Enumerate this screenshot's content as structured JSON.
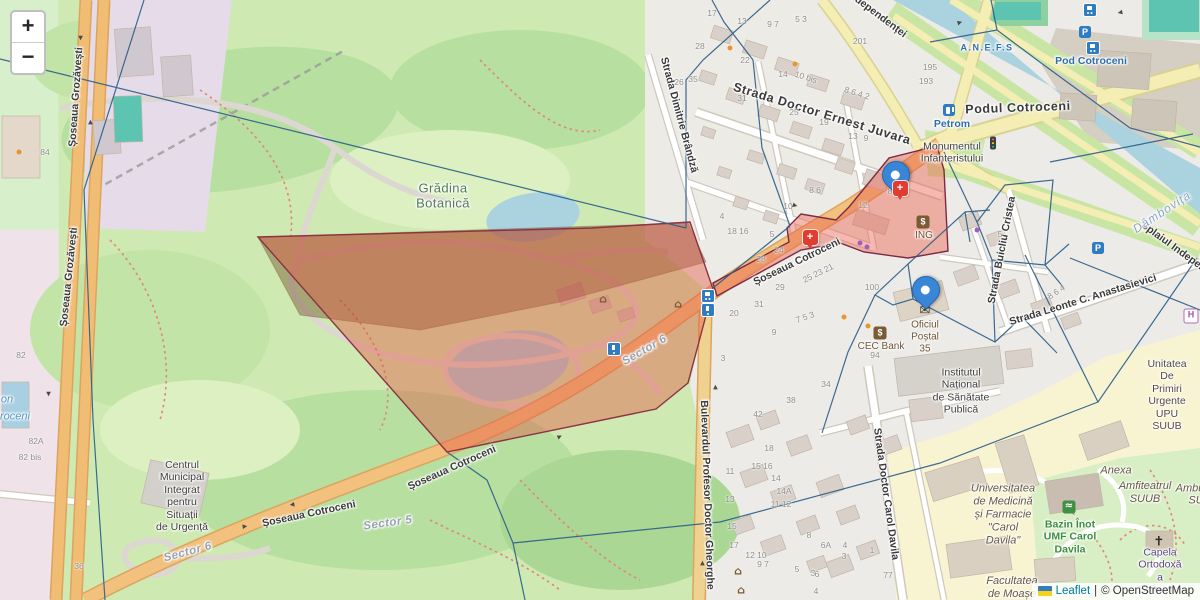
{
  "controls": {
    "zoom_in": "+",
    "zoom_out": "−"
  },
  "attribution": {
    "leaflet": "Leaflet",
    "sep": "|",
    "osm": "© OpenStreetMap",
    "flag_icon": "ukraine-flag",
    "flag_colors": [
      "#357ebd",
      "#f7d117"
    ]
  },
  "overlay_colors": {
    "selection_fill": "rgba(229,83,64,0.42)",
    "selection_dark_fill": "rgba(105,62,25,0.40)",
    "selection_stroke": "#7d3146",
    "voronoi_stroke": "#2d5f8a",
    "marker_blue": "#3a86d6",
    "marker_red": "#e23b30"
  },
  "glyphs": {
    "arrow": "▶",
    "parking": "P",
    "bank": "$",
    "hospital": "H",
    "swim": "≈",
    "museum": "⌂",
    "post": "✉",
    "chapel": "✝",
    "medical_cross": "+"
  },
  "streets": [
    {
      "text": "Șoseaua Grozăvești",
      "x": 76,
      "y": 97,
      "r": -86
    },
    {
      "text": "Șoseaua Grozăvești",
      "x": 69,
      "y": 277,
      "r": -84
    },
    {
      "text": "Strada Doctor Ernest Juvara",
      "x": 822,
      "y": 114,
      "r": 17,
      "cls": "major"
    },
    {
      "text": "Șoseaua Cotroceni",
      "x": 797,
      "y": 262,
      "r": -26
    },
    {
      "text": "Șoseaua Cotroceni",
      "x": 452,
      "y": 468,
      "r": -24
    },
    {
      "text": "Șoseaua Cotroceni",
      "x": 309,
      "y": 514,
      "r": -12
    },
    {
      "text": "Bulevardul Profesor Doctor Gheorghe",
      "x": 707,
      "y": 495,
      "r": 88
    },
    {
      "text": "Strada Doctor Carol Davila",
      "x": 886,
      "y": 494,
      "r": 82
    },
    {
      "text": "Strada Dimitrie Brândză",
      "x": 679,
      "y": 115,
      "r": 75
    },
    {
      "text": "Strada Buicliu Cristea",
      "x": 1002,
      "y": 250,
      "r": -79
    },
    {
      "text": "Strada Leonte C. Anastasievici",
      "x": 1083,
      "y": 300,
      "r": -17
    },
    {
      "text": "Splaiul Independenței",
      "x": 862,
      "y": 3,
      "r": 37
    },
    {
      "text": "Splaiul Independenței",
      "x": 1186,
      "y": 256,
      "r": 36
    },
    {
      "text": "Podul Cotroceni",
      "x": 1018,
      "y": 108,
      "r": -2,
      "cls": "major"
    }
  ],
  "places": [
    {
      "text": "Grădina\nBotanică",
      "x": 443,
      "y": 196,
      "cls": "p-green"
    },
    {
      "text": "Pod Cotroceni",
      "x": 1091,
      "y": 61,
      "cls": "p-blue"
    },
    {
      "text": "A.N.E.F.S",
      "x": 987,
      "y": 48,
      "cls": "p-bluesm"
    },
    {
      "text": "Petrom",
      "x": 952,
      "y": 124,
      "cls": "p-blue"
    },
    {
      "text": "Monumentul\nInfanteristului",
      "x": 952,
      "y": 153,
      "cls": "p-dark"
    },
    {
      "text": "Dâmbovița",
      "x": 1162,
      "y": 212,
      "cls": "p-water",
      "r": -33
    },
    {
      "text": "Sector 6",
      "x": 645,
      "y": 351,
      "cls": "p-sector",
      "r": -30
    },
    {
      "text": "Sector 6",
      "x": 188,
      "y": 553,
      "cls": "p-sector",
      "r": -15
    },
    {
      "text": "Sector 5",
      "x": 388,
      "y": 524,
      "cls": "p-sector",
      "r": -8
    },
    {
      "text": "ING",
      "x": 924,
      "y": 236,
      "cls": "p-amen"
    },
    {
      "text": "CEC Bank",
      "x": 881,
      "y": 347,
      "cls": "p-amen"
    },
    {
      "text": "Oficiul\nPoștal\n35",
      "x": 925,
      "y": 337,
      "cls": "p-amen"
    },
    {
      "text": "Institutul\nNațional\nde Sănătate\nPublică",
      "x": 961,
      "y": 391,
      "cls": "p-dark"
    },
    {
      "text": "Centrul\nMunicipal\nIntegrat\npentru\nSituații\nde Urgență",
      "x": 182,
      "y": 496,
      "cls": "p-dark"
    },
    {
      "text": "Universitatea\nde Medicină\nși Farmacie\n\"Carol\nDavila\"",
      "x": 1003,
      "y": 515,
      "cls": "p-univ"
    },
    {
      "text": "Anexa",
      "x": 1116,
      "y": 471,
      "cls": "p-univ"
    },
    {
      "text": "Amfiteatrul\nSUUB",
      "x": 1145,
      "y": 493,
      "cls": "p-univ"
    },
    {
      "text": "Ambu",
      "x": 1190,
      "y": 489,
      "cls": "p-univ"
    },
    {
      "text": "SU",
      "x": 1196,
      "y": 501,
      "cls": "p-univ"
    },
    {
      "text": "Bazin Înot\nUMF Carol\nDavila",
      "x": 1070,
      "y": 537,
      "cls": "p-greensm"
    },
    {
      "text": "Capela\nOrtodoxă\na Spitalului",
      "x": 1160,
      "y": 571,
      "cls": "p-purple"
    },
    {
      "text": "Unitatea\nDe Primiri\nUrgente\nUPU\nSUUB",
      "x": 1167,
      "y": 395,
      "cls": "p-hosp"
    },
    {
      "text": "Facultatea\nde Moașe",
      "x": 1012,
      "y": 588,
      "cls": "p-univ"
    },
    {
      "text": "on",
      "x": 7,
      "y": 400,
      "cls": "p-waterblue"
    },
    {
      "text": "roceni",
      "x": 15,
      "y": 417,
      "cls": "p-waterblue"
    }
  ],
  "house_numbers": [
    {
      "t": "84",
      "x": 45,
      "y": 152
    },
    {
      "t": "82",
      "x": 21,
      "y": 355
    },
    {
      "t": "82A",
      "x": 36,
      "y": 441
    },
    {
      "t": "82 bis",
      "x": 30,
      "y": 457
    },
    {
      "t": "36",
      "x": 79,
      "y": 566
    },
    {
      "t": "201",
      "x": 860,
      "y": 41
    },
    {
      "t": "195",
      "x": 930,
      "y": 67
    },
    {
      "t": "193",
      "x": 926,
      "y": 81
    },
    {
      "t": "17",
      "x": 712,
      "y": 13
    },
    {
      "t": "13",
      "x": 742,
      "y": 21
    },
    {
      "t": "9 7",
      "x": 773,
      "y": 24
    },
    {
      "t": "5 3",
      "x": 801,
      "y": 19
    },
    {
      "t": "28",
      "x": 700,
      "y": 46
    },
    {
      "t": "22",
      "x": 745,
      "y": 60
    },
    {
      "t": "14",
      "x": 783,
      "y": 74
    },
    {
      "t": "10 bis",
      "x": 806,
      "y": 77,
      "r": 17
    },
    {
      "t": "26",
      "x": 679,
      "y": 82
    },
    {
      "t": "35",
      "x": 693,
      "y": 79
    },
    {
      "t": "8 6 4 2",
      "x": 857,
      "y": 93,
      "r": 17
    },
    {
      "t": "31",
      "x": 742,
      "y": 98
    },
    {
      "t": "25",
      "x": 794,
      "y": 112
    },
    {
      "t": "19",
      "x": 824,
      "y": 122
    },
    {
      "t": "13",
      "x": 853,
      "y": 136
    },
    {
      "t": "9",
      "x": 866,
      "y": 138
    },
    {
      "t": "12",
      "x": 863,
      "y": 205
    },
    {
      "t": "8",
      "x": 890,
      "y": 191
    },
    {
      "t": "10",
      "x": 788,
      "y": 206
    },
    {
      "t": "8 6",
      "x": 815,
      "y": 190
    },
    {
      "t": "4",
      "x": 722,
      "y": 216
    },
    {
      "t": "18 16",
      "x": 738,
      "y": 231
    },
    {
      "t": "5",
      "x": 772,
      "y": 234
    },
    {
      "t": "24",
      "x": 779,
      "y": 250
    },
    {
      "t": "28",
      "x": 761,
      "y": 259
    },
    {
      "t": "25 23 21",
      "x": 818,
      "y": 273,
      "r": -26
    },
    {
      "t": "29",
      "x": 780,
      "y": 287
    },
    {
      "t": "20",
      "x": 734,
      "y": 313
    },
    {
      "t": "31",
      "x": 759,
      "y": 304
    },
    {
      "t": "100",
      "x": 872,
      "y": 287
    },
    {
      "t": "7 5 3",
      "x": 805,
      "y": 317,
      "r": -20
    },
    {
      "t": "9",
      "x": 774,
      "y": 332
    },
    {
      "t": "3",
      "x": 723,
      "y": 358
    },
    {
      "t": "94",
      "x": 875,
      "y": 355
    },
    {
      "t": "42",
      "x": 758,
      "y": 414
    },
    {
      "t": "34",
      "x": 826,
      "y": 384
    },
    {
      "t": "38",
      "x": 791,
      "y": 400
    },
    {
      "t": "18",
      "x": 769,
      "y": 448
    },
    {
      "t": "15 16",
      "x": 762,
      "y": 466
    },
    {
      "t": "14",
      "x": 776,
      "y": 478
    },
    {
      "t": "14A",
      "x": 784,
      "y": 491
    },
    {
      "t": "11 12",
      "x": 781,
      "y": 504
    },
    {
      "t": "13",
      "x": 730,
      "y": 499
    },
    {
      "t": "11",
      "x": 730,
      "y": 471
    },
    {
      "t": "15",
      "x": 732,
      "y": 526
    },
    {
      "t": "17",
      "x": 734,
      "y": 545
    },
    {
      "t": "12 10",
      "x": 756,
      "y": 555
    },
    {
      "t": "9 7",
      "x": 763,
      "y": 564
    },
    {
      "t": "5",
      "x": 797,
      "y": 569
    },
    {
      "t": "3",
      "x": 813,
      "y": 573
    },
    {
      "t": "8",
      "x": 809,
      "y": 535
    },
    {
      "t": "6A",
      "x": 826,
      "y": 545
    },
    {
      "t": "6",
      "x": 817,
      "y": 574
    },
    {
      "t": "4",
      "x": 816,
      "y": 591
    },
    {
      "t": "4",
      "x": 845,
      "y": 545
    },
    {
      "t": "3",
      "x": 844,
      "y": 556
    },
    {
      "t": "1",
      "x": 872,
      "y": 550
    },
    {
      "t": "77",
      "x": 888,
      "y": 575
    },
    {
      "t": "8 6 4",
      "x": 1056,
      "y": 292,
      "r": -33
    },
    {
      "t": "5",
      "x": 1000,
      "y": 234
    }
  ],
  "icons": [
    {
      "t": "bus",
      "x": 1090,
      "y": 10
    },
    {
      "t": "bus",
      "x": 1093,
      "y": 48
    },
    {
      "t": "bus",
      "x": 708,
      "y": 296
    },
    {
      "t": "tram",
      "x": 708,
      "y": 310
    },
    {
      "t": "tram",
      "x": 614,
      "y": 349
    },
    {
      "t": "parking",
      "x": 1085,
      "y": 32,
      "g": "P"
    },
    {
      "t": "parking",
      "x": 1098,
      "y": 248,
      "g": "P"
    },
    {
      "t": "fuel",
      "x": 949,
      "y": 110
    },
    {
      "t": "traffic",
      "x": 993,
      "y": 143
    },
    {
      "t": "museum",
      "x": 603,
      "y": 299,
      "g": "⌂"
    },
    {
      "t": "museum",
      "x": 678,
      "y": 304,
      "g": "⌂"
    },
    {
      "t": "museum",
      "x": 738,
      "y": 571,
      "g": "⌂"
    },
    {
      "t": "museum",
      "x": 741,
      "y": 590,
      "g": "⌂"
    },
    {
      "t": "post",
      "x": 925,
      "y": 311,
      "g": "✉"
    },
    {
      "t": "bank",
      "x": 880,
      "y": 333,
      "g": "$"
    },
    {
      "t": "bank",
      "x": 923,
      "y": 222,
      "g": "$"
    },
    {
      "t": "hospital",
      "x": 1191,
      "y": 316,
      "g": "H"
    },
    {
      "t": "swim",
      "x": 1069,
      "y": 507,
      "g": "≈"
    },
    {
      "t": "chapel",
      "x": 1159,
      "y": 542,
      "g": "✝"
    },
    {
      "t": "dot-orange",
      "x": 730,
      "y": 48
    },
    {
      "t": "dot-orange",
      "x": 795,
      "y": 64
    },
    {
      "t": "dot-orange",
      "x": 844,
      "y": 317
    },
    {
      "t": "dot-orange",
      "x": 868,
      "y": 326
    },
    {
      "t": "dot-orange",
      "x": 19,
      "y": 152
    },
    {
      "t": "dot-purple",
      "x": 860,
      "y": 243
    },
    {
      "t": "dot-purple",
      "x": 867,
      "y": 247
    },
    {
      "t": "dot-purple",
      "x": 977,
      "y": 230
    }
  ],
  "markers": [
    {
      "t": "pin-blue",
      "x": 895,
      "y": 193
    },
    {
      "t": "pin-blue",
      "x": 925,
      "y": 308
    },
    {
      "t": "pin-red",
      "x": 900,
      "y": 188,
      "g": "+"
    },
    {
      "t": "pin-red",
      "x": 810,
      "y": 237,
      "g": "+"
    }
  ],
  "arrows": [
    {
      "x": 80,
      "y": 38,
      "r": 90
    },
    {
      "x": 91,
      "y": 122,
      "r": -90
    },
    {
      "x": 48,
      "y": 394,
      "r": 90
    },
    {
      "x": 245,
      "y": 527,
      "r": -8
    },
    {
      "x": 292,
      "y": 504,
      "r": 172
    },
    {
      "x": 560,
      "y": 437,
      "r": -27
    },
    {
      "x": 716,
      "y": 387,
      "r": -90
    },
    {
      "x": 703,
      "y": 563,
      "r": -90
    },
    {
      "x": 795,
      "y": 206,
      "r": 15
    },
    {
      "x": 960,
      "y": 23,
      "r": -15
    },
    {
      "x": 1120,
      "y": 12,
      "r": 168
    }
  ]
}
